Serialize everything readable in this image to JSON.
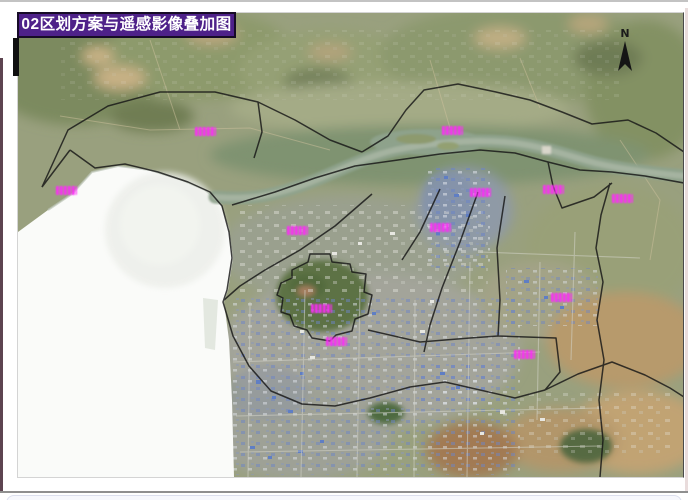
{
  "header": {
    "title": "02区划方案与遥感影像叠加图"
  },
  "map": {
    "type": "satellite-imagery-with-zoning-overlay",
    "compass_label": "N",
    "labels": [
      {
        "x": 187,
        "y": 119
      },
      {
        "x": 434,
        "y": 118
      },
      {
        "x": 48,
        "y": 178
      },
      {
        "x": 462,
        "y": 180
      },
      {
        "x": 535,
        "y": 177
      },
      {
        "x": 604,
        "y": 186
      },
      {
        "x": 279,
        "y": 218
      },
      {
        "x": 422,
        "y": 215
      },
      {
        "x": 303,
        "y": 296
      },
      {
        "x": 318,
        "y": 329
      },
      {
        "x": 543,
        "y": 285
      },
      {
        "x": 506,
        "y": 342
      }
    ],
    "label_note": "magenta place-name labels, illegible at source resolution"
  },
  "colors": {
    "title_bg": "#4e2189",
    "title_text": "#ffffff",
    "place_label": "#e838d8",
    "boundary_line": "#161616"
  }
}
